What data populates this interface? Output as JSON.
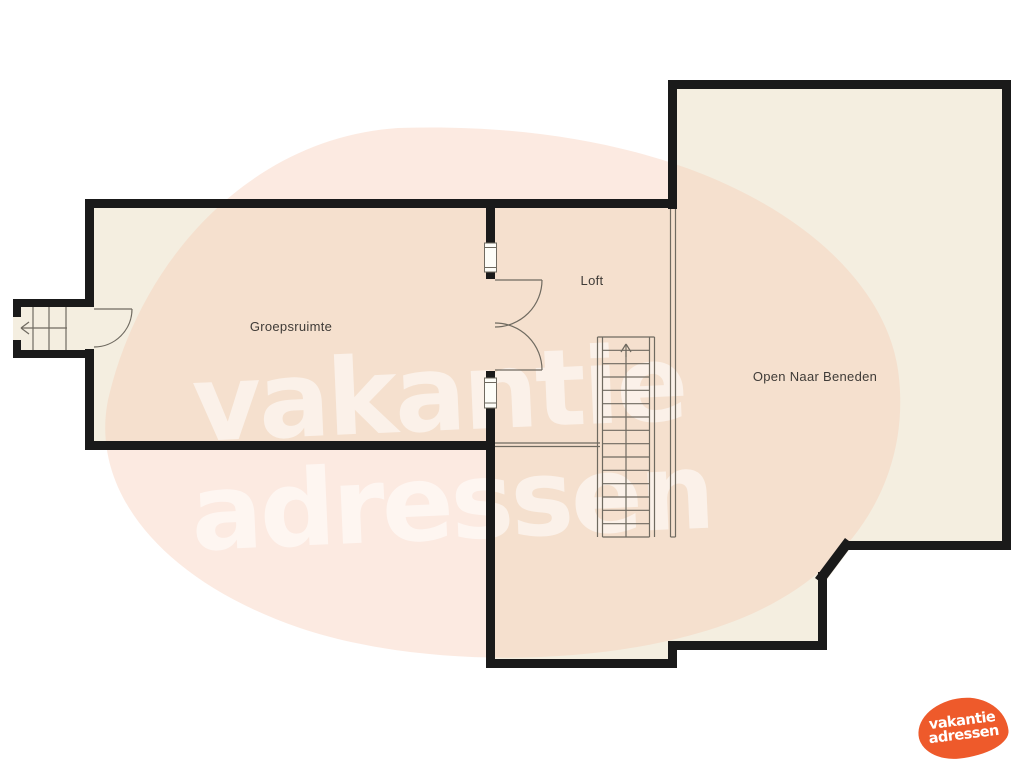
{
  "page": {
    "type": "floorplan-upper-level"
  },
  "rooms": {
    "groepsruimte": "Groepsruimte",
    "loft": "Loft",
    "open_naar_beneden": "Open Naar Beneden"
  },
  "watermark": {
    "line1": "vakantie",
    "line2": "adressen"
  },
  "logo": {
    "line1": "vakantie",
    "line2": "adressen"
  },
  "colors": {
    "background": "#ffffff",
    "wall": "#1a1a1a",
    "floor": "#f4eee0",
    "thin_line": "#6f6a60",
    "window_fill": "#fdfdf8",
    "watermark_blob": "#f7cbb4",
    "watermark_text": "#ffffff",
    "label_text": "#3f3b37",
    "logo_orange": "#ee5a2b",
    "logo_text": "#ffffff"
  },
  "icons": {
    "stairs-up-arrow": "↑",
    "exit-left-arrow": "←"
  }
}
